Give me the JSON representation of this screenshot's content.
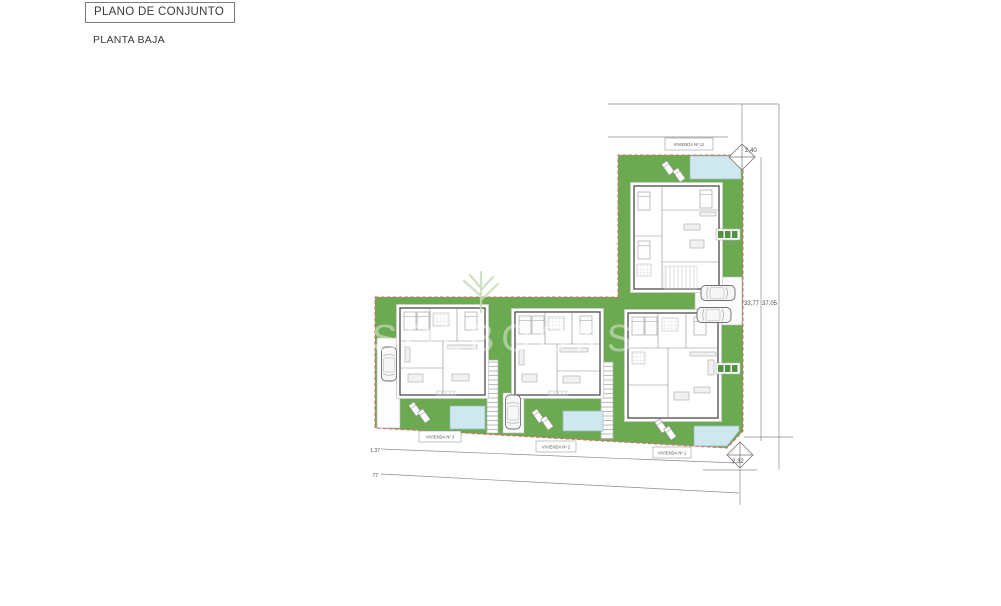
{
  "title_block": {
    "title": "PLANO DE CONJUNTO",
    "subtitle": "PLANTA BAJA"
  },
  "plan": {
    "house_labels": {
      "top": "VIVIENDA Nº 12",
      "bottom_left": "VIVIENDA Nº 3",
      "bottom_middle": "VIVIENDA Nº 2",
      "bottom_right": "VIVIENDA Nº 1"
    },
    "dimensions": {
      "top_right_offset": "2,40",
      "bottom_right_offset": "2,32",
      "right_inner_length": "33,77",
      "right_outer_length": "37,05",
      "bottom_upper_line": "1,37",
      "bottom_lower_line": "77"
    },
    "watermark_text": "SOLBOOKS",
    "colors": {
      "garden_green": "#6caa52",
      "pool_blue": "#cfe8ef",
      "boundary_red": "#e0696e"
    }
  }
}
